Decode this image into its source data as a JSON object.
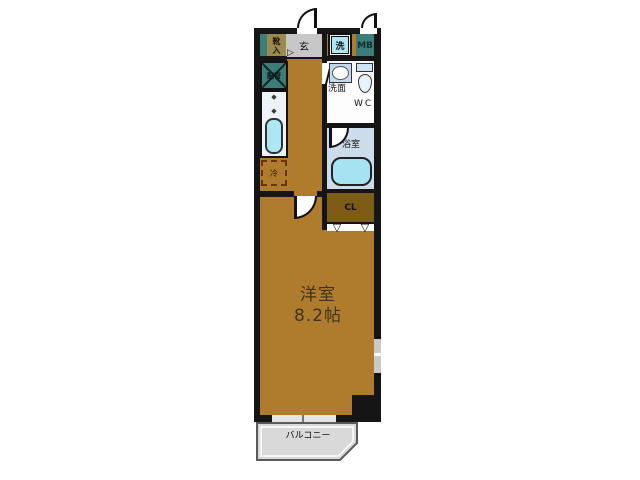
{
  "floorplan": {
    "labels": {
      "shoe_cabinet": "靴入",
      "entrance": "玄",
      "washer": "洗",
      "meter_box": "MB",
      "pipe_space": "配管",
      "refrigerator": "冷",
      "washroom": "洗面",
      "wc": "WC",
      "bathroom": "浴室",
      "closet": "CL",
      "main_room_name": "洋室",
      "main_room_size": "8.2帖",
      "balcony": "バルコニー"
    },
    "icons": {
      "burner": "◆",
      "fold_door": "▽",
      "step_marker": "▷"
    },
    "colors": {
      "wall": "#151515",
      "floor_wood": "#ae7c2c",
      "closet_brown": "#7d5c16",
      "service_teal": "#3c7d78",
      "shoe_olive": "#9b8a4e",
      "entrance_gray": "#c7c7c7",
      "fixture_cyan": "#aee8f2",
      "bath_blue": "#ccdcea",
      "balcony_gray": "#d9d9d9"
    }
  }
}
